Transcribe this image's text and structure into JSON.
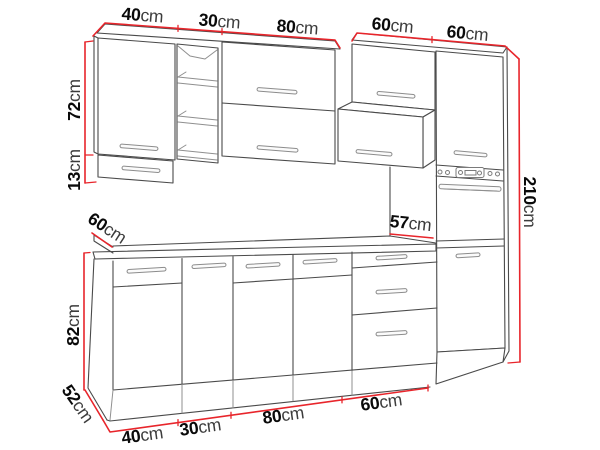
{
  "dimensions": {
    "top": [
      {
        "v": "40",
        "u": "cm"
      },
      {
        "v": "30",
        "u": "cm"
      },
      {
        "v": "80",
        "u": "cm"
      },
      {
        "v": "60",
        "u": "cm"
      },
      {
        "v": "60",
        "u": "cm"
      }
    ],
    "wall_cabinet_height": {
      "v": "72",
      "u": "cm"
    },
    "wall_cabinet_extension": {
      "v": "13",
      "u": "cm"
    },
    "counter_depth": {
      "v": "60",
      "u": "cm"
    },
    "base_height": {
      "v": "82",
      "u": "cm"
    },
    "plinth_depth": {
      "v": "52",
      "u": "cm"
    },
    "splashback_gap": {
      "v": "57",
      "u": "cm"
    },
    "total_height": {
      "v": "210",
      "u": "cm"
    },
    "bottom": [
      {
        "v": "40",
        "u": "cm"
      },
      {
        "v": "30",
        "u": "cm"
      },
      {
        "v": "80",
        "u": "cm"
      },
      {
        "v": "60",
        "u": "cm"
      }
    ]
  },
  "colors": {
    "dimension_line": "#e8252b",
    "outline": "#4a4a4a",
    "background": "#ffffff",
    "label_number": "#0a0a0a",
    "label_unit": "#3c3c3c"
  }
}
